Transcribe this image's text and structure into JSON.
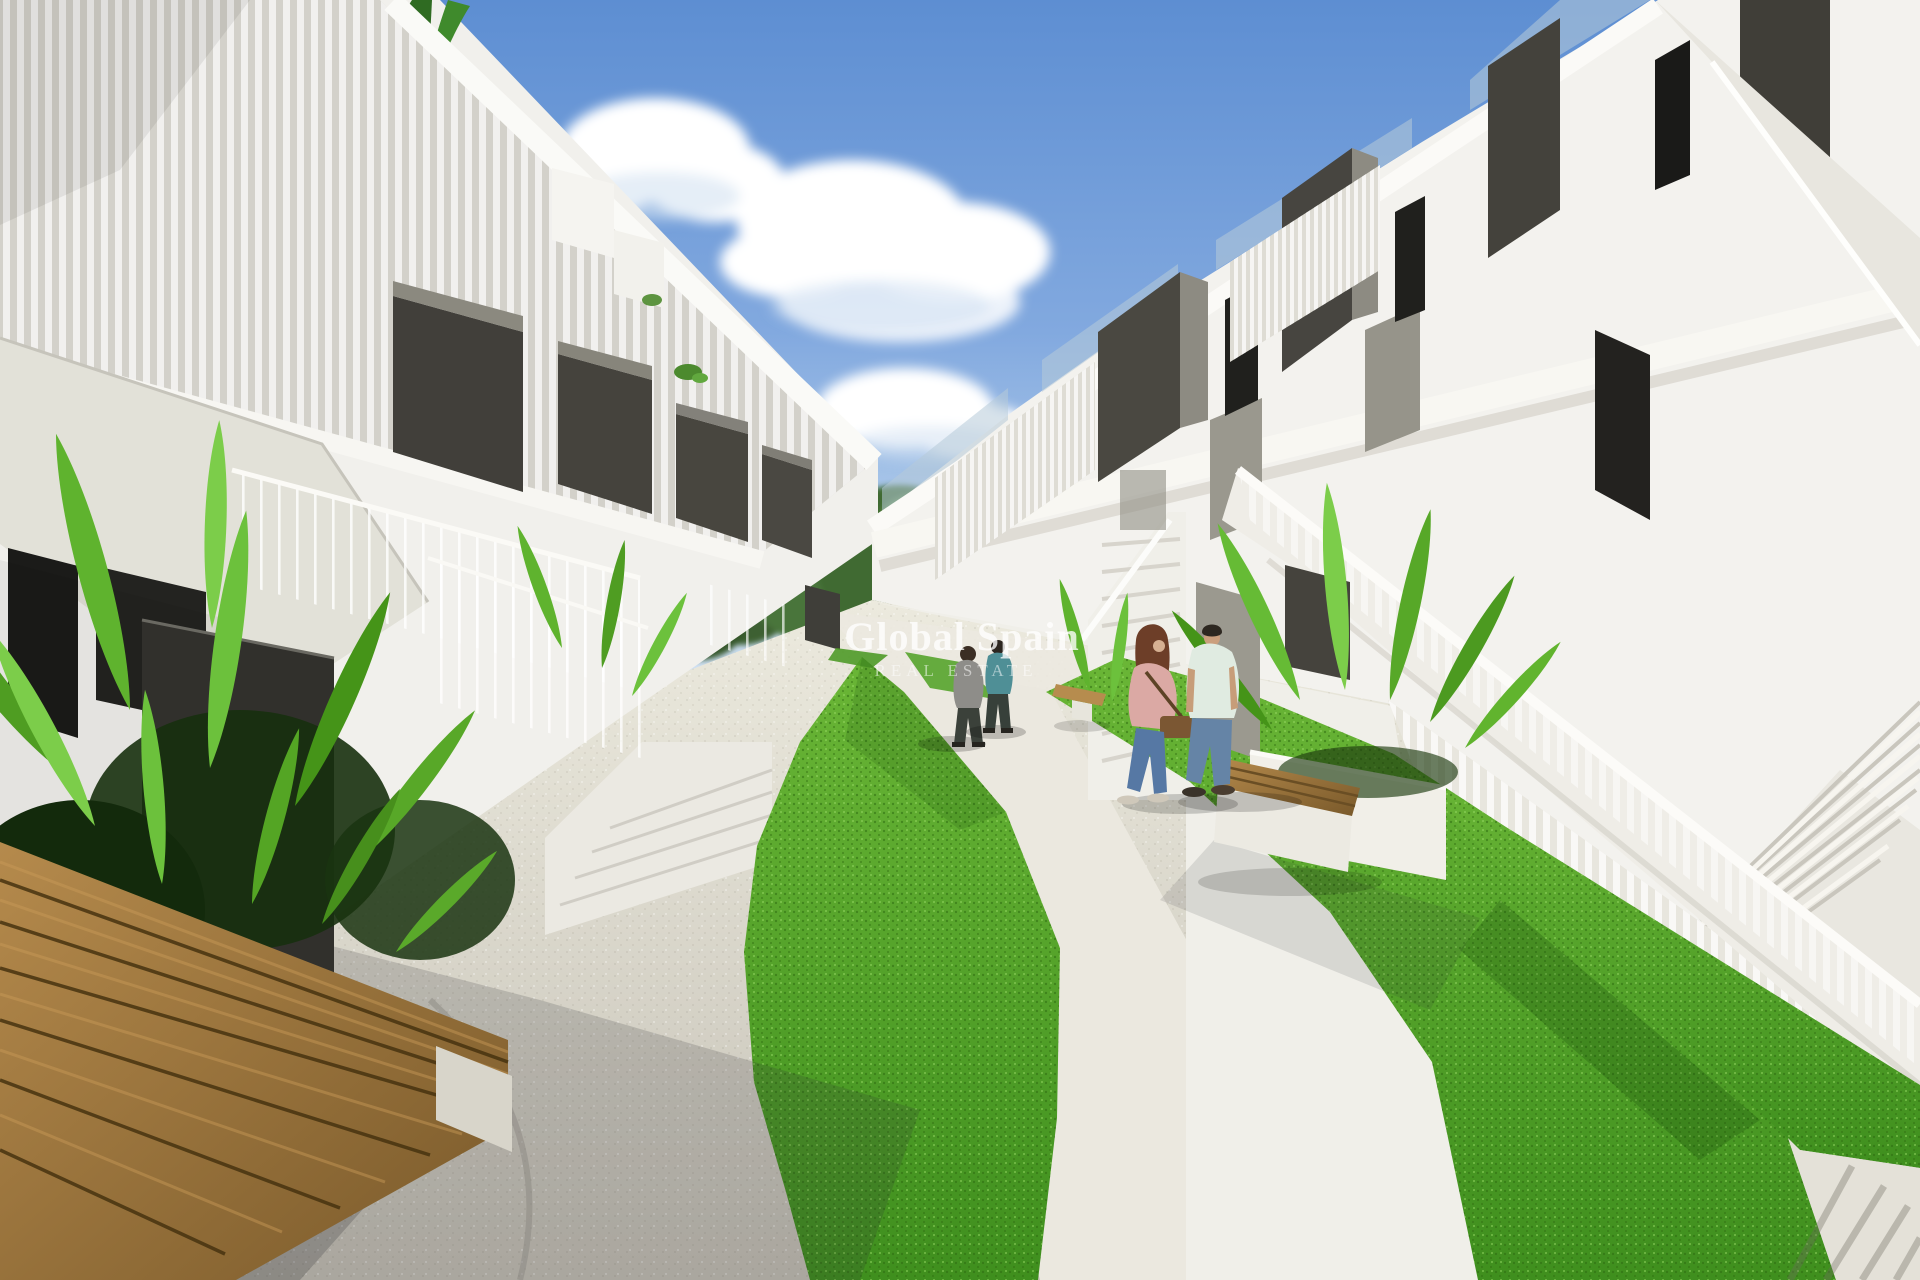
{
  "image": {
    "kind": "architectural-render-photo",
    "subject": "Modern white two-storey apartment complex courtyard (new-build style), external staircases with white slatted balustrades, dark grey balcony panels, curved concrete walkway between bright green lawn strips, tropical planters, wooden benches and four pedestrians under a blue sky with clouds",
    "width_px": 1920,
    "height_px": 1280
  },
  "watermark": {
    "line1": "Global Spain",
    "line2": "REAL ESTATE",
    "text_color": "#ffffff"
  },
  "palette": {
    "sky_top": "#5d8ed2",
    "sky_horizon": "#dfeaf6",
    "cloud": "#ffffff",
    "building_white": "#f2f1ed",
    "building_shade": "#e2e1d8",
    "fascia_white": "#fbfaf7",
    "balcony_panel_dark": "#45433d",
    "balcony_panel_light": "#8d8b82",
    "window_dark": "#1d1d1b",
    "railing_slat_grey": "#d3d1ca",
    "glass_balustrade": "#b7cbd8",
    "grass_light": "#6ab636",
    "grass_dark": "#3f8f1e",
    "foliage_bright": "#6cc13c",
    "foliage_deep": "#2f6b22",
    "distant_trees": "#3f6a33",
    "path_sunlit": "#ebe8df",
    "path_shadow": "#b9b6ad",
    "concrete": "#d9d6cd",
    "bench_wood": "#a57c41",
    "planter_dark": "#31302c"
  },
  "scene": {
    "elements": [
      {
        "name": "sky",
        "description": "clear blue sky, brighter toward horizon"
      },
      {
        "name": "clouds",
        "description": "white cumulus clouds left-of-center, mid-center and far right"
      },
      {
        "name": "distant-trees",
        "description": "green pine/shrub mass closing the courtyard vista"
      },
      {
        "name": "left-building",
        "description": "white block with grey slatted roof railing, dark grey hanging balcony boxes, dark door recesses, stair soffit and entry steps"
      },
      {
        "name": "right-building",
        "description": "white block with rooftop glass balustrade, dark divider panels, upper walkway and large external staircases"
      },
      {
        "name": "big-staircase",
        "description": "long white staircase with vertical-slat balustrade descending to the right foreground"
      },
      {
        "name": "mid-staircase",
        "description": "smaller straight stair rising from the walkway where the couple stands"
      },
      {
        "name": "lawn-strips",
        "description": "two curved bright green lawn bands flanking the white walkway"
      },
      {
        "name": "walkway",
        "description": "curving light travertine path through the courtyard"
      },
      {
        "name": "left-planter-bench",
        "description": "foreground planter with large tropical leaves, dark planter box and long wooden slat bench in shadow"
      },
      {
        "name": "right-planter-bench",
        "description": "white planter with bright leaves, dark divider panels and wood-topped bench"
      },
      {
        "name": "small-bench",
        "description": "small wooden bench at the lawn edge mid-ground"
      }
    ],
    "people": [
      {
        "id": "distant-man-grey",
        "description": "man walking away, grey top, dark trousers",
        "top_color": "#8e8d89"
      },
      {
        "id": "distant-man-teal",
        "description": "man walking away, teal shirt, dark trousers",
        "top_color": "#4f8f96"
      },
      {
        "id": "woman-pink",
        "description": "woman with auburn hair, rose jacket, blue jeans, brown shoulder bag",
        "top_color": "#dba9a4"
      },
      {
        "id": "man-mint",
        "description": "man with dark hair, mint white t-shirt, light blue jeans",
        "top_color": "#e0ebe1"
      }
    ]
  }
}
